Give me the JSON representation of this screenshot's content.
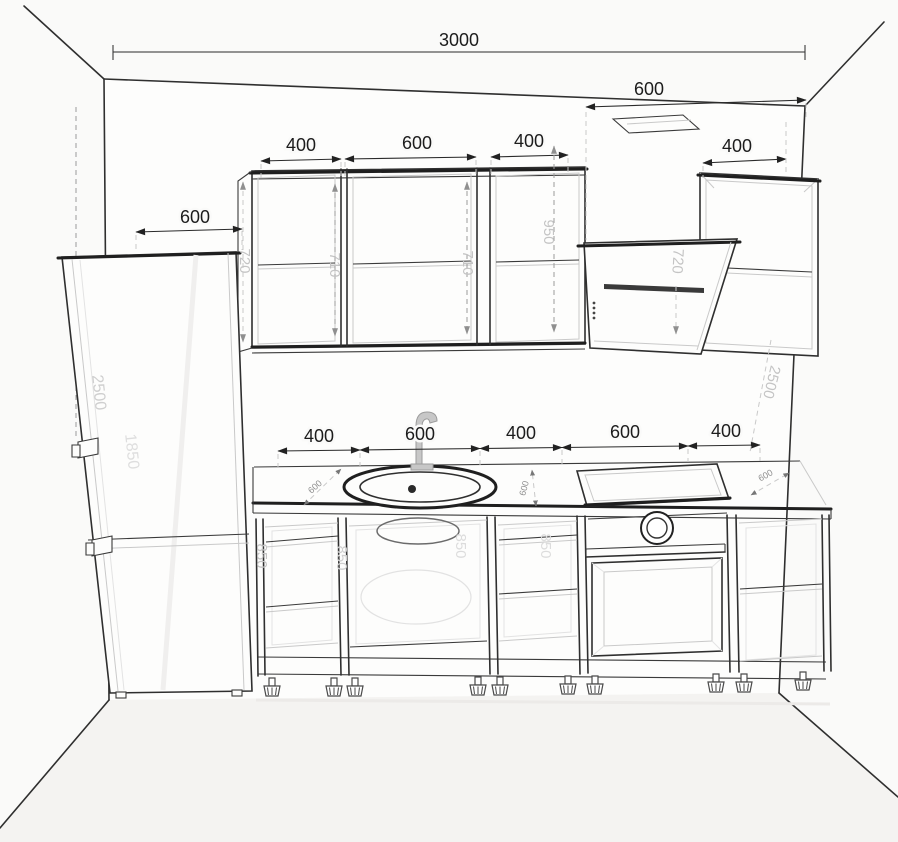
{
  "dims": {
    "wall_width": "3000",
    "hood_zone_width": "600",
    "upper_row": [
      "400",
      "600",
      "400"
    ],
    "right_wall_cabinet": "400",
    "fridge_zone": "600",
    "wall_cab_height": "720",
    "wall_cab_inner_1": "710",
    "wall_cab_inner_2": "710",
    "hood_clearance": "950",
    "hood_height": "720",
    "right_wall_height": "2500",
    "fridge_height": "2500",
    "fridge_door_height": "1850",
    "base_row": [
      "400",
      "600",
      "400",
      "600",
      "400"
    ],
    "base_heights": [
      "850",
      "850",
      "850",
      "850"
    ],
    "counter_depths": [
      "600",
      "600",
      "600"
    ]
  },
  "colors": {
    "line": "#2f2f2f",
    "dim_text": "#1c1c1c",
    "gray_dim_text": "#c4c4c4",
    "paper": "#fafaf9"
  }
}
